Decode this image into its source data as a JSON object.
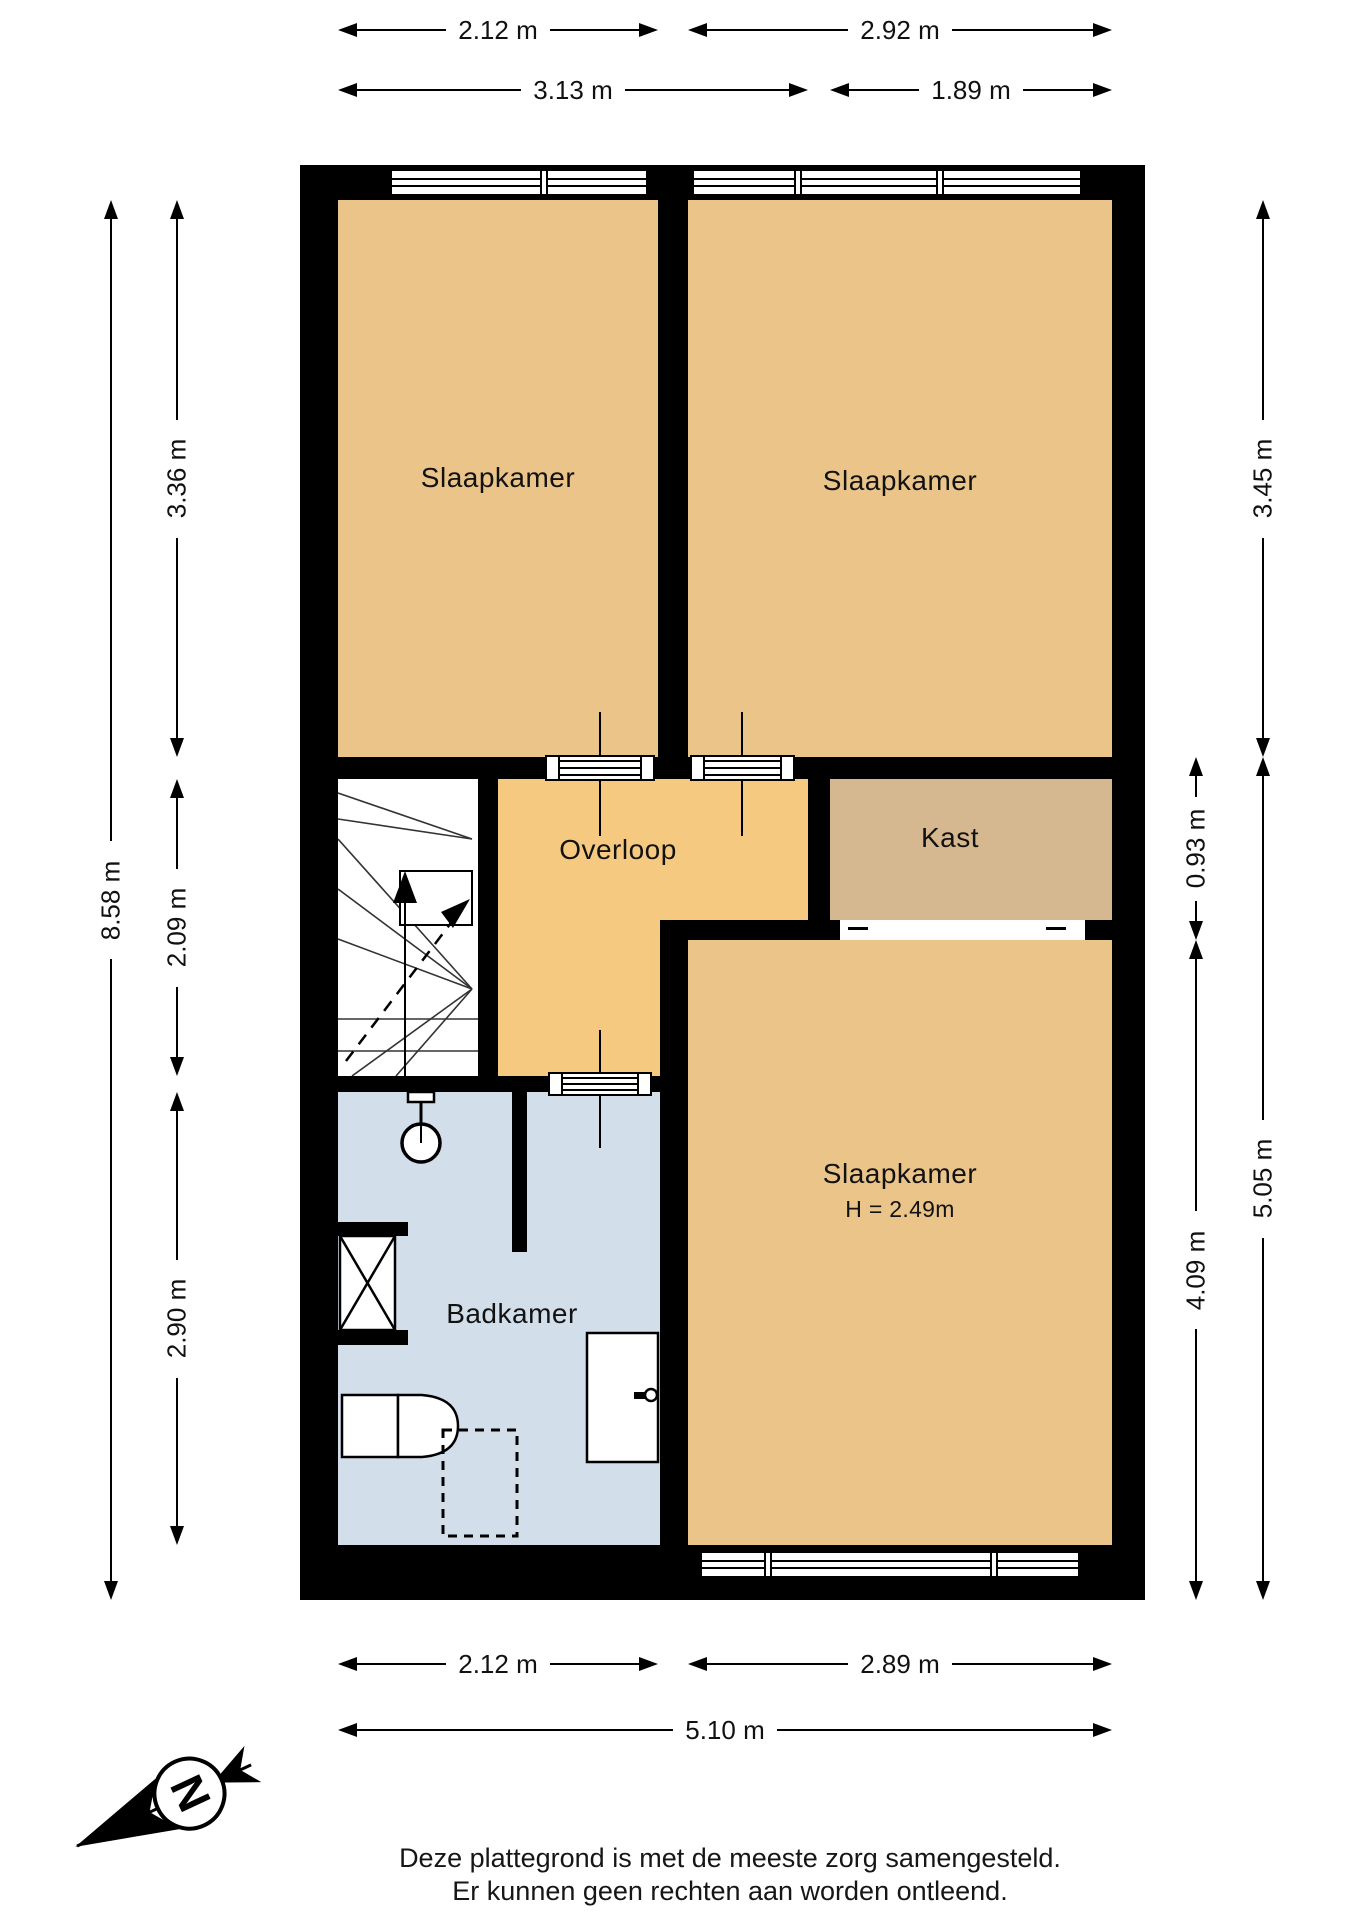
{
  "plan": {
    "rooms": {
      "bedroom_top_left": {
        "label": "Slaapkamer"
      },
      "bedroom_top_right": {
        "label": "Slaapkamer"
      },
      "bedroom_bottom": {
        "label": "Slaapkamer",
        "height_note": "H = 2.49m"
      },
      "landing": {
        "label": "Overloop"
      },
      "closet": {
        "label": "Kast"
      },
      "bathroom": {
        "label": "Badkamer"
      }
    },
    "colors": {
      "room_tan": "#eac489",
      "landing_orange": "#f6c981",
      "closet_tan": "#d5b88f",
      "bathroom_blue": "#d2dfeb",
      "wall": "#000000",
      "background": "#ffffff"
    }
  },
  "dimensions": {
    "top_row1_left": "2.12 m",
    "top_row1_right": "2.92 m",
    "top_row2_left": "3.13 m",
    "top_row2_right": "1.89 m",
    "left_outer": "8.58 m",
    "left_top": "3.36 m",
    "left_middle": "2.09 m",
    "left_bottom": "2.90 m",
    "right_inner_top": "0.93 m",
    "right_inner_bottom": "4.09 m",
    "right_outer_top": "3.45 m",
    "right_outer_bottom": "5.05 m",
    "bottom_row1_left": "2.12 m",
    "bottom_row1_right": "2.89 m",
    "bottom_row2": "5.10 m"
  },
  "compass": {
    "north_label": "N"
  },
  "footer": {
    "line1": "Deze plattegrond is met de meeste zorg samengesteld.",
    "line2": "Er kunnen geen rechten aan worden ontleend."
  }
}
